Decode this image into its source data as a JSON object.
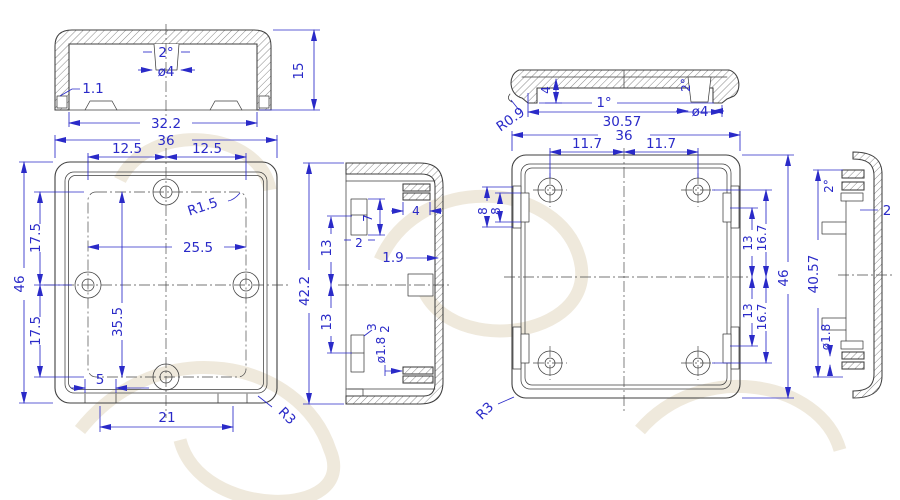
{
  "colors": {
    "geometry": "#3f3f3f",
    "dimension": "#2a2ac8",
    "background": "#ffffff",
    "watermark": "#efe9dc"
  },
  "views": {
    "cover_section_front": {
      "dims": {
        "draft": "2°",
        "boss_dia": "ø4",
        "wall_thickness": "1.1",
        "inner_width": "32.2",
        "height": "15"
      }
    },
    "base_front": {
      "dims": {
        "width": "36",
        "pitch_left": "12.5",
        "pitch_right": "12.5",
        "fillet": "R1.5",
        "boss_span": "25.5",
        "height": "46",
        "pitch_upper": "17.5",
        "pitch_lower": "17.5",
        "boss_height": "35.5",
        "slot_width": "5",
        "slot_span": "21",
        "corner_radius": "R3"
      }
    },
    "base_section_side": {
      "dims": {
        "height": "42.2",
        "rib_upper": "13",
        "rib_lower": "13",
        "rib_width": "2",
        "rib_height": "7",
        "lip_width": "4",
        "wall_thickness": "1.9",
        "boss_width": "3",
        "boss_step": "2",
        "hole_dia": "ø1.8"
      }
    },
    "cover_section_side": {
      "dims": {
        "corner_radius": "R0.9",
        "lip_height": "4",
        "draft_wall": "1°",
        "draft_boss": "2°",
        "boss_dia": "ø4",
        "inner_length": "30.57"
      }
    },
    "cover_inside": {
      "dims": {
        "width": "36",
        "pitch_left": "11.7",
        "pitch_right": "11.7",
        "tab_outer": "8",
        "tab_inner": "8",
        "tab_upper": "13",
        "hole_upper": "16.7",
        "tab_lower": "13",
        "hole_lower": "16.7",
        "height": "46",
        "corner_radius": "R3"
      }
    },
    "cover_section_end": {
      "dims": {
        "draft": "2°",
        "wall_thickness": "2",
        "inner_length": "40.57",
        "hole_dia": "ø1.8"
      }
    }
  }
}
